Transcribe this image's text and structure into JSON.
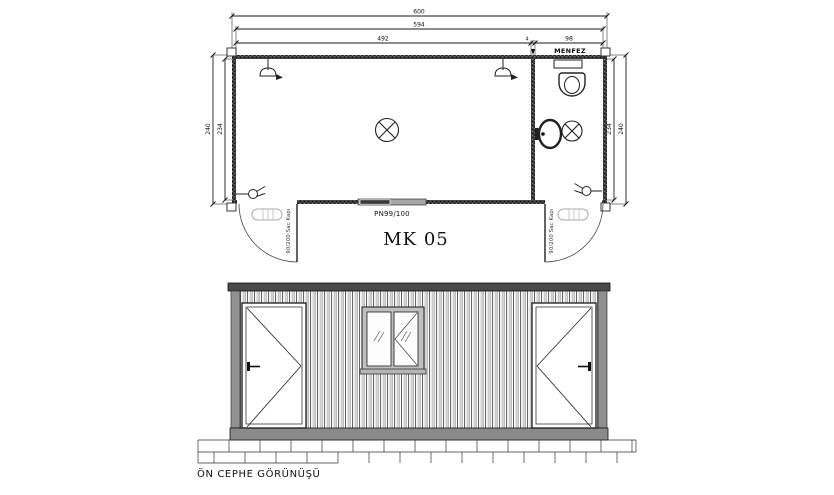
{
  "drawing": {
    "title": "MK 05",
    "caption": "ÖN CEPHE GÖRÜNÜŞÜ"
  },
  "plan": {
    "dim_total": "600",
    "dim_inner": "594",
    "dim_main_room": "492",
    "dim_partition": "4",
    "dim_wc": "98",
    "dim_left_outer": "240",
    "dim_left_inner": "234",
    "dim_right_inner": "234",
    "dim_right_outer": "240",
    "vent_label": "MENFEZ",
    "window_label": "PN99/100",
    "door_left_label": "90/200 Sac Kapı",
    "door_right_label": "90/200 Sac Kapı"
  },
  "colors": {
    "background": "#ffffff",
    "line": "#1a1a1a",
    "wall": "#3c3c3c",
    "rail_dark": "#4a4a4a",
    "rail_light": "#8a8a8a",
    "corrugation_band": "#cccccc",
    "window_frame": "#c0c0c0"
  }
}
